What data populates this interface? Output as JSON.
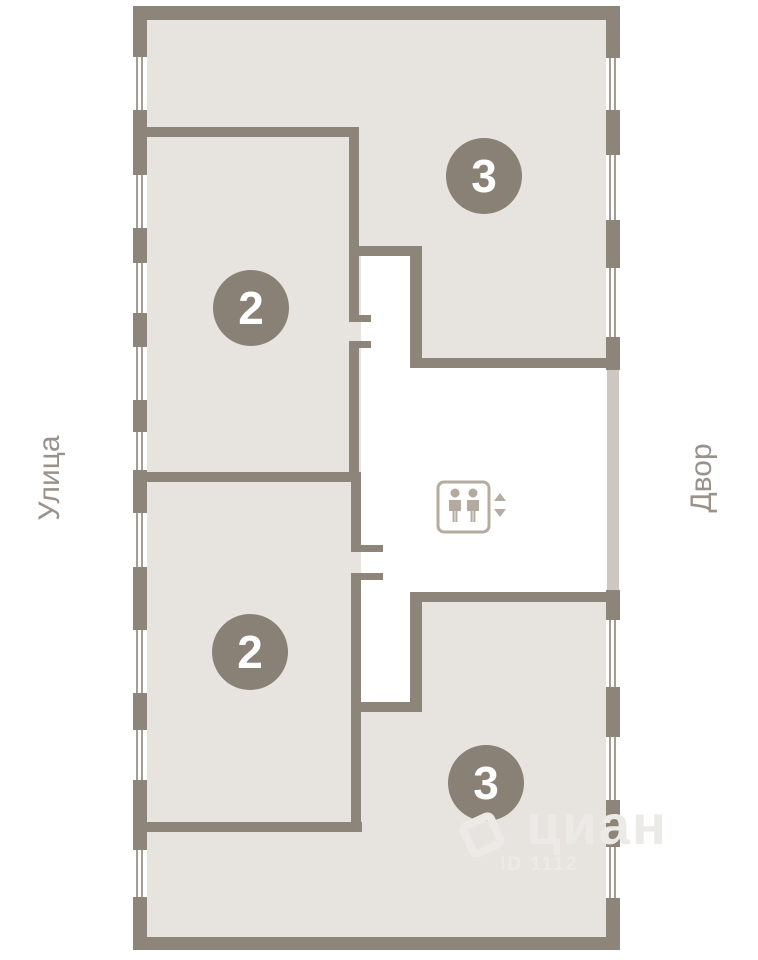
{
  "plan": {
    "street_label": "Улица",
    "courtyard_label": "Двор",
    "units": [
      {
        "number": "3",
        "position": "upper-right"
      },
      {
        "number": "2",
        "position": "upper-left"
      },
      {
        "number": "2",
        "position": "lower-left"
      },
      {
        "number": "3",
        "position": "lower-right"
      }
    ],
    "icons": {
      "elevator": "elevator-icon",
      "up": "arrow-up-icon",
      "down": "arrow-down-icon",
      "windows": "window-glyph"
    }
  },
  "watermark": {
    "brand": "циан",
    "id": "ID 1112"
  },
  "colors": {
    "wall": "#8e857a",
    "room_fill": "#e7e4e0",
    "badge": "#8a8176",
    "facade_light": "#ccc7c0",
    "label_gray": "#9a928a",
    "elevator_gray": "#b5ac9f"
  }
}
